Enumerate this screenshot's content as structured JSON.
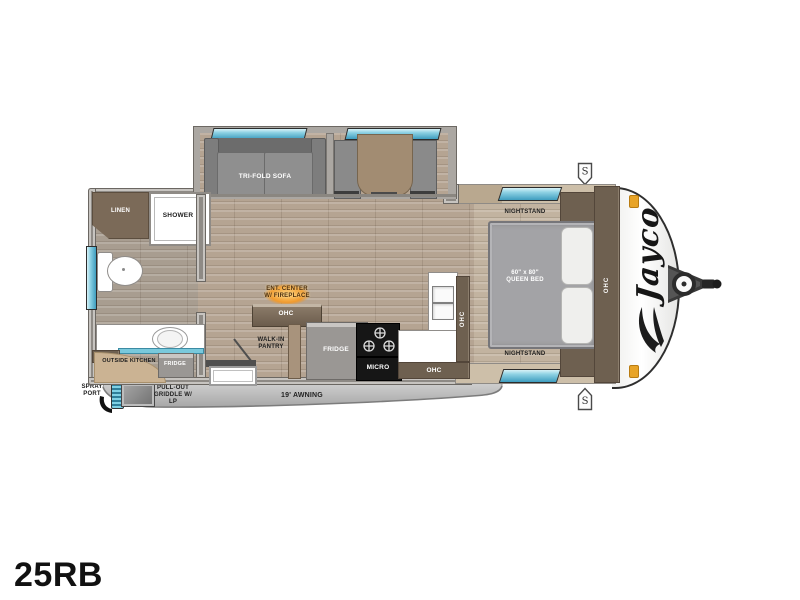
{
  "model": "25RB",
  "brand": "Jayco",
  "labels": {
    "sofa": "TRI-FOLD SOFA",
    "linen": "LINEN",
    "shower": "SHOWER",
    "med": "MED",
    "outside_kitchen": "OUTSIDE KITCHEN",
    "fridge": "FRIDGE",
    "spray_port": "SPRAY PORT",
    "griddle": "PULL-OUT GRIDDLE W/ LP",
    "awning": "19' AWNING",
    "ent_center": "ENT. CENTER W/ FIREPLACE",
    "ohc": "OHC",
    "pantry": "WALK-IN PANTRY",
    "micro": "MICRO",
    "nightstand": "NIGHTSTAND",
    "bed_size": "60\" x 80\"",
    "bed_type": "QUEEN BED",
    "speaker": "S"
  },
  "colors": {
    "window_glass": "#5ab4d4",
    "cabinet_brown": "#6e6050",
    "wood_table": "#a28c72",
    "wall_gray": "#8e8a85",
    "wall_beige": "#cdbfa9",
    "marker_orange": "#e8a428",
    "flame_orange": "#f09a2e"
  }
}
